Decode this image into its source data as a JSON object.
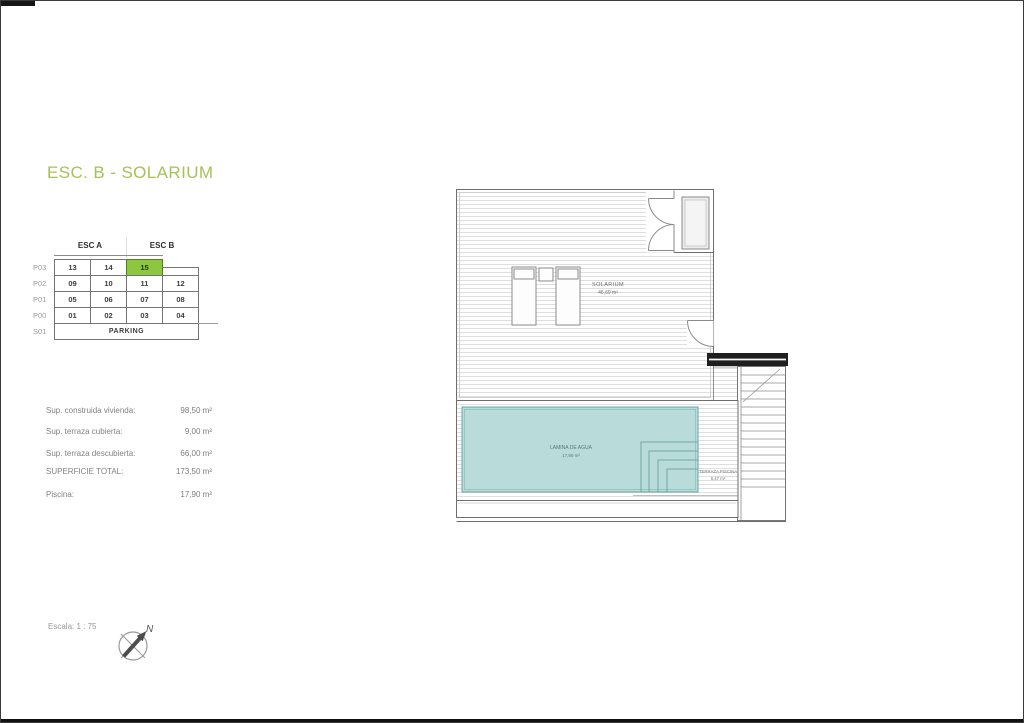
{
  "page": {
    "title": "ESC. B - SOLARIUM",
    "title_color": "#a5c257"
  },
  "key_table": {
    "headers": [
      "ESC A",
      "ESC B"
    ],
    "row_labels": [
      "P03",
      "P02",
      "P01",
      "P00",
      "S01"
    ],
    "p03": [
      "13",
      "14",
      "15"
    ],
    "p02": [
      "09",
      "10",
      "11",
      "12"
    ],
    "p01": [
      "05",
      "06",
      "07",
      "08"
    ],
    "p00": [
      "01",
      "02",
      "03",
      "04"
    ],
    "parking": "PARKING",
    "highlighted_unit": "15",
    "highlight_color": "#8dc63f"
  },
  "areas": {
    "items": [
      {
        "label": "Sup. construida vivienda:",
        "value": "98,50 m²"
      },
      {
        "label": "Sup. terraza cubierta:",
        "value": "9,00 m²"
      },
      {
        "label": "Sup. terraza descubierta:",
        "value": "66,00 m²"
      },
      {
        "label": "SUPERFICIE TOTAL:",
        "value": "173,50 m²"
      },
      {
        "label": "Piscina:",
        "value": "17,90 m²"
      }
    ]
  },
  "plan": {
    "solarium": {
      "label": "SOLARIUM",
      "area": "46,69 m²"
    },
    "pool": {
      "label": "LAMINA DE AGUA",
      "area": "17,90 m²",
      "color": "#b9dbda"
    },
    "pool_terrace": {
      "label": "TERRAZA PISCINA",
      "area": "6,47 m²"
    }
  },
  "footer": {
    "scale_label": "Escala: 1 : 75",
    "north_label": "N"
  }
}
